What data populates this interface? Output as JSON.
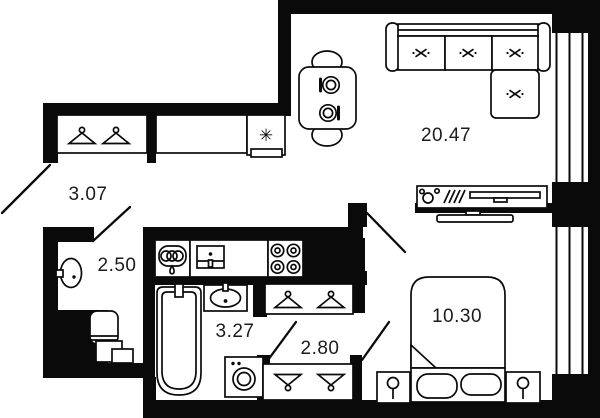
{
  "plan": {
    "rooms": [
      {
        "name": "hallway",
        "area_label": "3.07"
      },
      {
        "name": "storage-room",
        "area_label": "2.50"
      },
      {
        "name": "bathroom",
        "area_label": "3.27"
      },
      {
        "name": "wardrobe-corridor",
        "area_label": "2.80"
      },
      {
        "name": "bedroom",
        "area_label": "10.30"
      },
      {
        "name": "living-kitchen",
        "area_label": "20.47"
      }
    ],
    "icons": {
      "fridge_snowflake": "✳"
    },
    "colors": {
      "wall": "#0a0a0a",
      "background": "#ffffff",
      "line": "#0a0a0a",
      "label_text": "#1c1c1c"
    }
  }
}
